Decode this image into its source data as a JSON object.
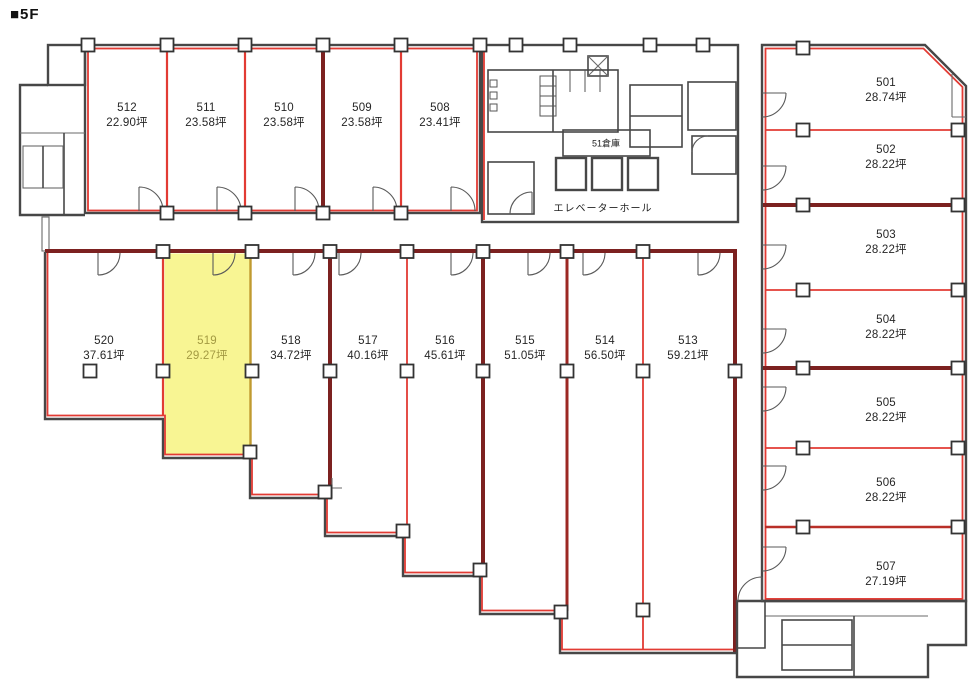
{
  "title": "■5F",
  "floor": "5F",
  "rooms": {
    "top_row": [
      {
        "id": "512",
        "area": "22.90坪"
      },
      {
        "id": "511",
        "area": "23.58坪"
      },
      {
        "id": "510",
        "area": "23.58坪"
      },
      {
        "id": "509",
        "area": "23.58坪"
      },
      {
        "id": "508",
        "area": "23.41坪"
      }
    ],
    "middle_row": [
      {
        "id": "520",
        "area": "37.61坪"
      },
      {
        "id": "519",
        "area": "29.27坪",
        "highlighted": true
      },
      {
        "id": "518",
        "area": "34.72坪"
      },
      {
        "id": "517",
        "area": "40.16坪"
      },
      {
        "id": "516",
        "area": "45.61坪"
      },
      {
        "id": "515",
        "area": "51.05坪"
      },
      {
        "id": "514",
        "area": "56.50坪"
      },
      {
        "id": "513",
        "area": "59.21坪"
      }
    ],
    "right_column": [
      {
        "id": "501",
        "area": "28.74坪"
      },
      {
        "id": "502",
        "area": "28.22坪"
      },
      {
        "id": "503",
        "area": "28.22坪"
      },
      {
        "id": "504",
        "area": "28.22坪"
      },
      {
        "id": "505",
        "area": "28.22坪"
      },
      {
        "id": "506",
        "area": "28.22坪"
      },
      {
        "id": "507",
        "area": "27.19坪"
      }
    ]
  },
  "core": {
    "storage_label": "51倉庫",
    "elevator_hall_label": "エレベーターホール"
  },
  "highlight": {
    "room_id": "519",
    "fill": "#f8f593",
    "text_color": "#a39a42"
  },
  "colors": {
    "outline_red": "#e23b34",
    "party_wall_dark_red": "#7c2120",
    "wall_gray": "#474747",
    "highlight_yellow": "#f8f593"
  }
}
